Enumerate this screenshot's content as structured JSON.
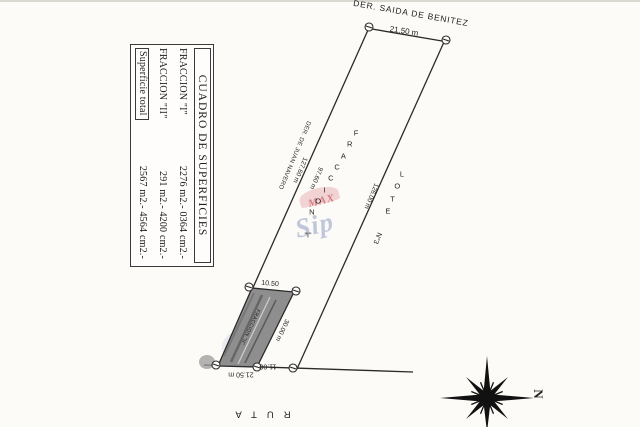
{
  "table": {
    "title": "CUADRO DE SUPERFICIES",
    "rows": [
      {
        "label": "FRACCION \"I\"",
        "value": "2276 m2.- 0364 cm2.-"
      },
      {
        "label": "FRACCION \"II\"",
        "value": "291 m2.- 4200 cm2.-"
      },
      {
        "label": "Superficie total",
        "value": "2567 m2.- 4564 cm2.-"
      }
    ]
  },
  "plan": {
    "north_boundary": {
      "name": "DER. SAIDA DE BENITEZ",
      "length": "21.50 m"
    },
    "west_boundary": {
      "name": "DER. DE JUAN NAVERO",
      "total_length": "127.60 m",
      "fraccion_i_length": "97.60 m"
    },
    "east_boundary": {
      "length": "126.00 m"
    },
    "south_boundary": {
      "name": "RUTA",
      "length": "21.50 m"
    },
    "fraccion_i": {
      "letters": "FRACCION",
      "suffix": "\"I\""
    },
    "fraccion_ii": {
      "inner_label": "FRACCION \"II\"",
      "top_length": "10.50",
      "side_length": "30.00 m",
      "bottom_length": "11.00"
    },
    "lote": {
      "letters": "LOTE",
      "suffix": "N°3"
    },
    "compass": {
      "north_label": "N"
    }
  },
  "watermark": {
    "line1": "MAX",
    "line2": "Sip"
  },
  "colors": {
    "ink": "#2a2a2a",
    "hatch_fill": "#8e8e8e",
    "paper": "#fcfbf8"
  }
}
